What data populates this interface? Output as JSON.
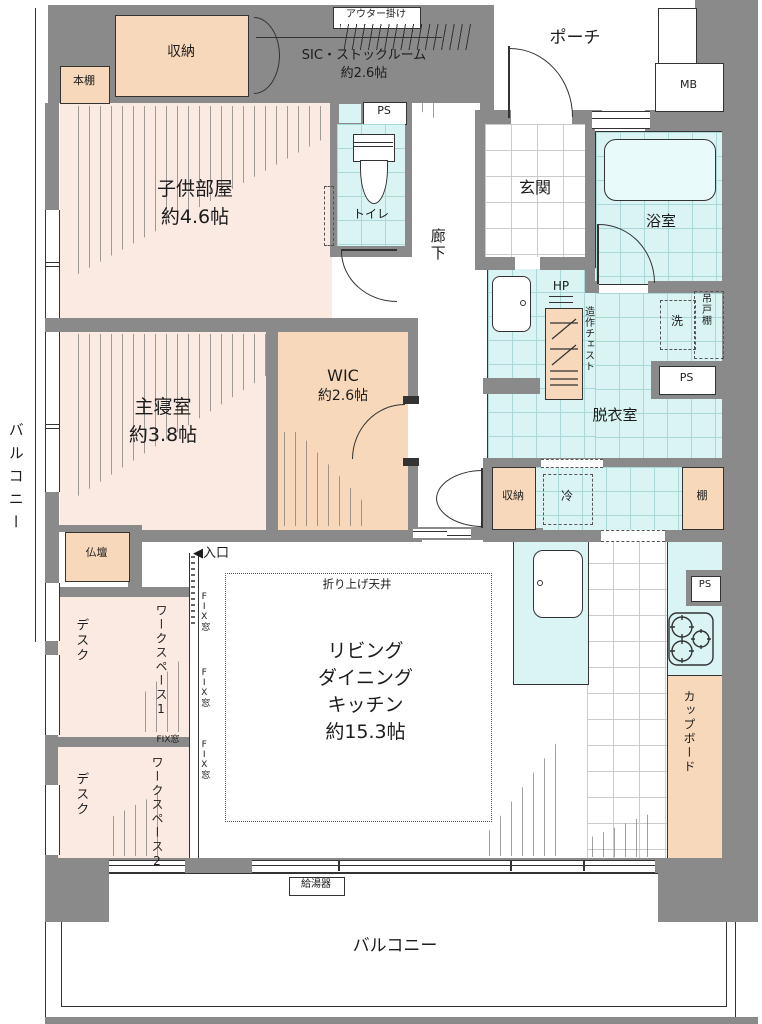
{
  "plan_title": "マンション間取り図",
  "labels": {
    "outer_hanger": "アウター掛け",
    "sic_name": "SIC・ストックルーム",
    "sic_size": "約2.6帖",
    "storage": "収納",
    "bookshelf": "本棚",
    "children_room": "子供部屋",
    "children_size": "約4.6帖",
    "ps": "PS",
    "toilet": "トイレ",
    "porch": "ポーチ",
    "mb": "MB",
    "entrance_hall": "玄関",
    "bathroom": "浴室",
    "corridor": "廊下",
    "hp": "HP",
    "chest": "造作チェスト",
    "washer": "洗",
    "hanging_cupboard": "吊戸棚",
    "dressing_room": "脱衣室",
    "master_bedroom": "主寝室",
    "master_size": "約3.8帖",
    "wic": "WIC",
    "wic_size": "約2.6帖",
    "altar": "仏壇",
    "fridge": "冷",
    "shelf": "棚",
    "entry_marker": "◀入口",
    "raised_ceiling": "折り上げ天井",
    "ldk_line1": "リビング",
    "ldk_line2": "ダイニング",
    "ldk_line3": "キッチン",
    "ldk_size": "約15.3帖",
    "desk": "デスク",
    "workspace1": "ワークスペース1",
    "workspace2": "ワークスペース2",
    "fix_window": "FIX窓",
    "cupboard": "カップボード",
    "water_heater": "給湯器",
    "balcony": "バルコニー"
  },
  "colors": {
    "wall": "#8a8a8a",
    "room_light_peach": "#fbeae1",
    "room_peach": "#f8d8ba",
    "room_cyan": "#d9f4f3",
    "line": "#333333"
  }
}
